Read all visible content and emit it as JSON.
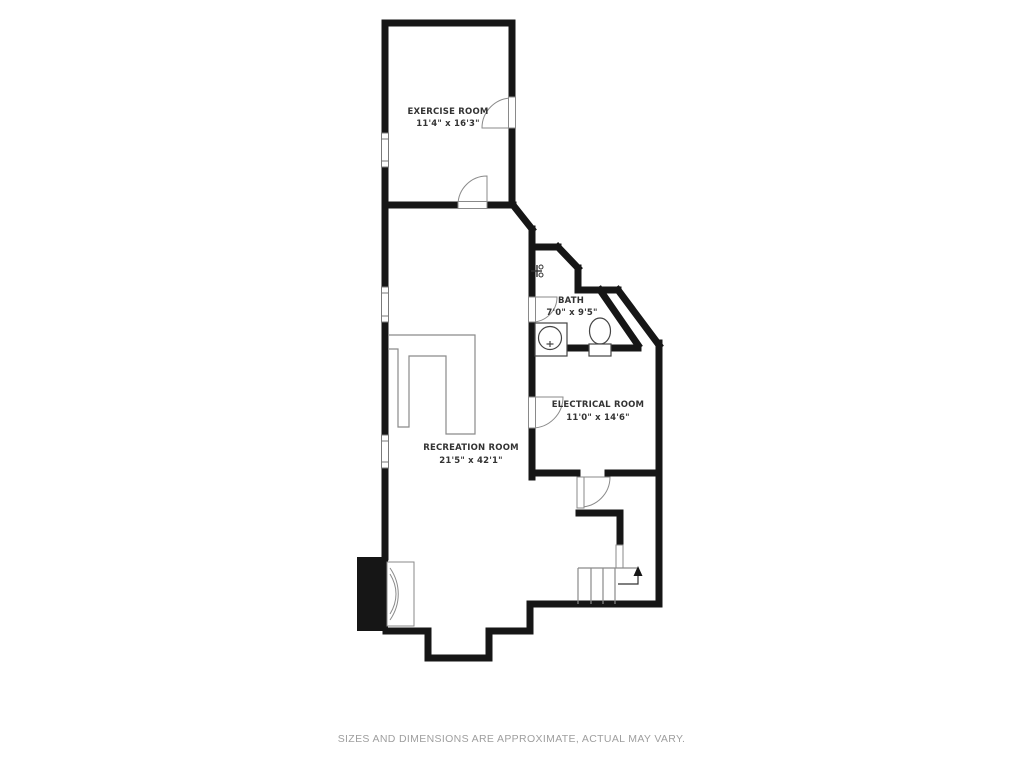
{
  "floor_plan": {
    "rooms": [
      {
        "name": "EXERCISE ROOM",
        "dimensions": "11'4\" x 16'3\""
      },
      {
        "name": "BATH",
        "dimensions": "7'0\" x 9'5\""
      },
      {
        "name": "ELECTRICAL ROOM",
        "dimensions": "11'0\" x 14'6\""
      },
      {
        "name": "RECREATION ROOM",
        "dimensions": "21'5\" x 42'1\""
      }
    ],
    "fixtures": [
      {
        "name": "sink"
      },
      {
        "name": "toilet"
      },
      {
        "name": "fireplace"
      },
      {
        "name": "staircase-up"
      },
      {
        "name": "hose-bib"
      }
    ],
    "window_count": 3,
    "door_count": 5,
    "colors": {
      "background": "#ffffff",
      "wall": "#161616",
      "fixture_line": "#7a7a7a",
      "label": "#333333",
      "footer_text": "#9e9e9e"
    }
  },
  "footer": {
    "disclaimer": "SIZES AND DIMENSIONS ARE APPROXIMATE, ACTUAL MAY VARY."
  }
}
